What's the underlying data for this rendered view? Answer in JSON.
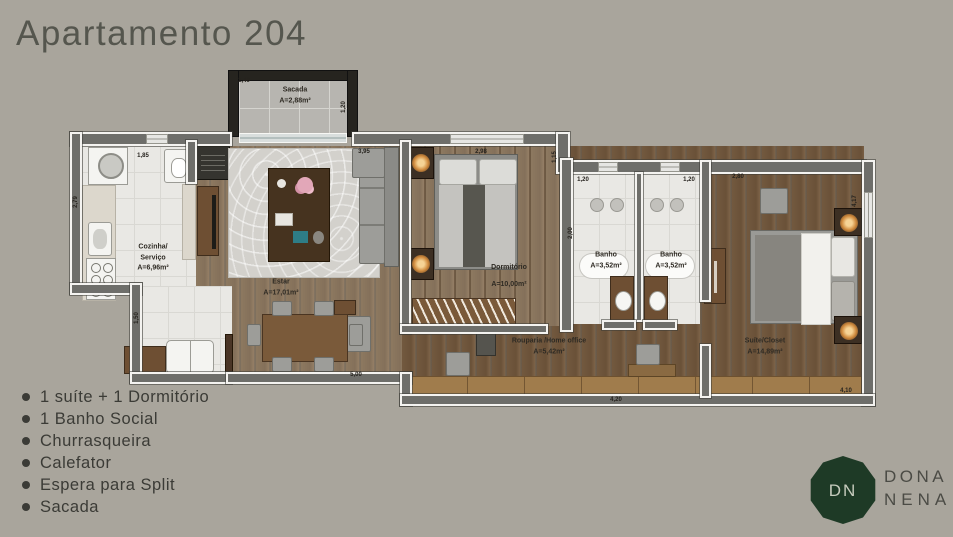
{
  "page": {
    "title": "Apartamento 204"
  },
  "features": {
    "items": [
      "1 suíte + 1 Dormitório",
      "1 Banho Social",
      "Churrasqueira",
      "Calefator",
      "Espera para Split",
      "Sacada"
    ]
  },
  "logo": {
    "initials": "DN",
    "line1": "DONA",
    "line2": "NENA"
  },
  "floorplan": {
    "rooms": {
      "sacada": {
        "name": "Sacada",
        "area": "A=2,88m²"
      },
      "cozinha": {
        "line1": "Cozinha/",
        "line2": "Serviço",
        "area": "A=6,96m²"
      },
      "estar": {
        "name": "Estar",
        "area": "A=17,01m²"
      },
      "dormitorio": {
        "name": "Dormitório",
        "area": "A=10,00m²"
      },
      "banho1": {
        "name": "Banho",
        "area": "A=3,52m²"
      },
      "banho2": {
        "name": "Banho",
        "area": "A=3,52m²"
      },
      "rouparia": {
        "name": "Rouparia /Home office",
        "area": "A=5,42m²"
      },
      "suite": {
        "name": "Suíte/Closet",
        "area": "A=14,89m²"
      }
    },
    "dims": {
      "sacada_w": "2,40",
      "sacada_h": "1,20",
      "cozinha_w": "1,85",
      "cozinha_h": "2,79",
      "cozinha_h2": "1,50",
      "estar_w": "3,95",
      "dorm_w": "2,98",
      "dorm_wall": "1,15",
      "banho1_w": "1,20",
      "banho2_w": "1,20",
      "banho_h": "2,00",
      "suite_w": "2,80",
      "suite_h": "4,17",
      "estar_bottom": "5,00",
      "hall_bottom": "4,20",
      "suite_bottom": "4,10"
    }
  },
  "colors": {
    "background": "#a9a59c",
    "title_text": "#55564e",
    "feature_text": "#3b3b36",
    "logo_green": "#1e3a26",
    "logo_text": "#4b4b45",
    "wall": "#6e6e6a",
    "balcony_wall": "#26241f",
    "tile_floor": "#e9e8e4",
    "wood_floor_light": "#8d7960",
    "wood_floor_dark": "#72593f"
  }
}
